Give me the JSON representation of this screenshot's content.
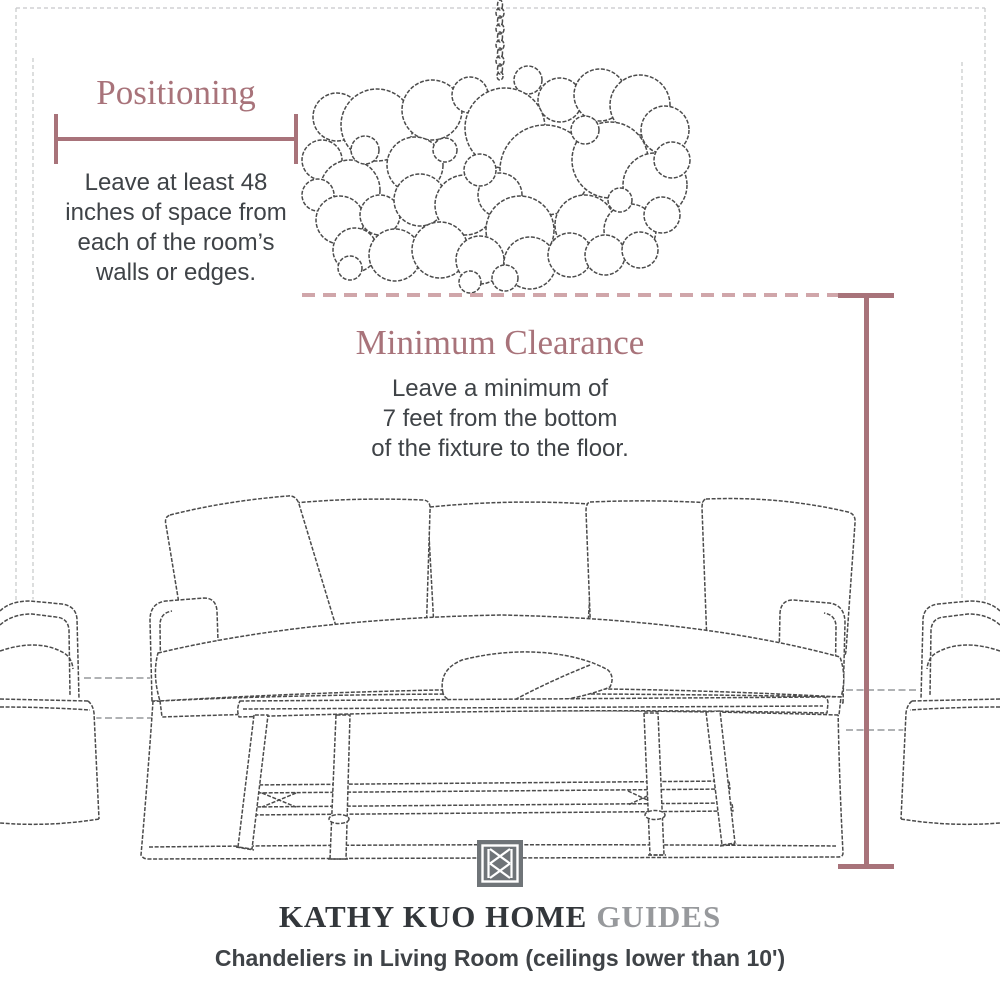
{
  "palette": {
    "accent": "#a8737a",
    "accent_light": "#d0a6aa",
    "ink": "#3f4347",
    "sketch": "#4b4b4b",
    "wall_line": "#95989b",
    "frame_line": "#c6c8c9",
    "brand_dark": "#33373b",
    "brand_muted": "#97999c",
    "logo_gray": "#6f7478",
    "paper": "#ffffff"
  },
  "annotations": {
    "positioning": {
      "title": "Positioning",
      "lines": [
        "Leave at least 48",
        "inches of space from",
        "each of the room’s",
        "walls or edges."
      ]
    },
    "clearance": {
      "title": "Minimum Clearance",
      "lines": [
        "Leave a minimum of",
        "7 feet from the bottom",
        "of the fixture to the floor."
      ]
    }
  },
  "measures": {
    "positioning_line": "48-inch-wall-offset-measure",
    "clearance_line": "7-foot-floor-clearance-measure"
  },
  "illustrations": {
    "room": "room-outline-sketch",
    "chandelier": "bubble-chandelier-sketch",
    "chain": "hanging-chain",
    "sofa": "slipcovered-sofa-sketch",
    "coffee_table": "bench-coffee-table-sketch",
    "armchair_left": "armchair-left-sketch",
    "armchair_right": "armchair-right-sketch"
  },
  "footer": {
    "brand": "KATHY KUO HOME",
    "brand_suffix": "GUIDES",
    "subtitle": "Chandeliers in Living Room (ceilings lower than 10')",
    "logo": "kathy-kuo-home-monogram"
  }
}
